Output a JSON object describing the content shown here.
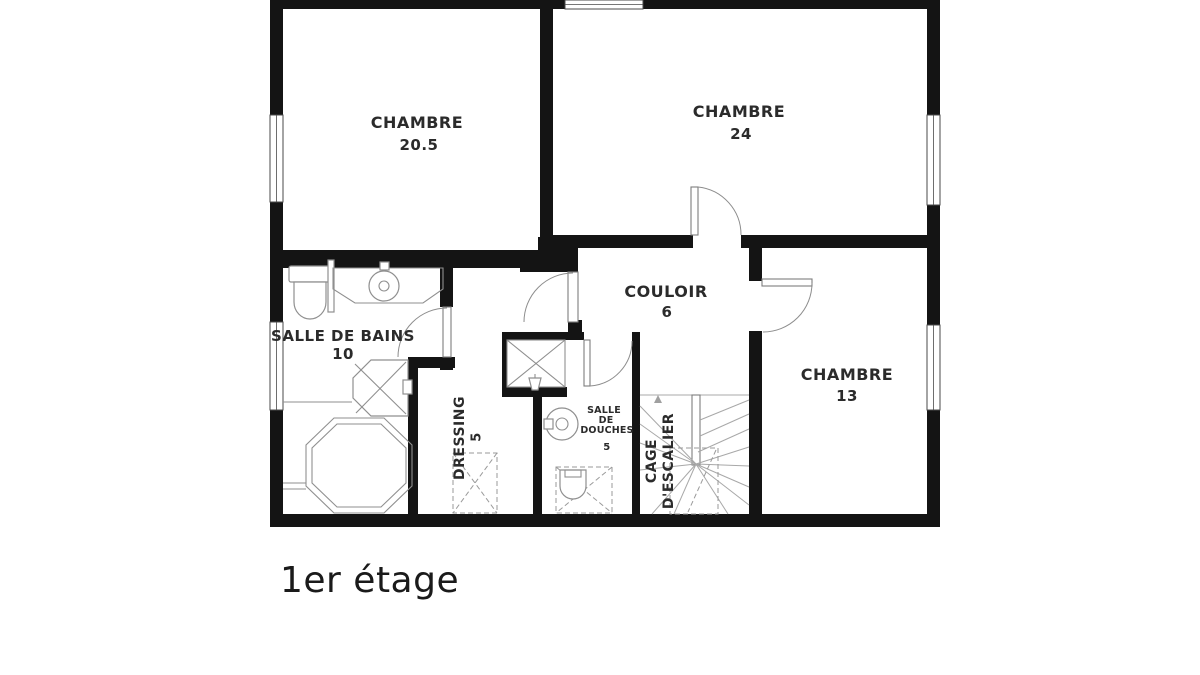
{
  "floor_plan": {
    "floor_label": "1er étage",
    "rooms": {
      "chambre_1": {
        "name": "CHAMBRE",
        "area": "20.5"
      },
      "chambre_2": {
        "name": "CHAMBRE",
        "area": "24"
      },
      "chambre_3": {
        "name": "CHAMBRE",
        "area": "13"
      },
      "salle_de_bains": {
        "name": "SALLE DE BAINS",
        "area": "10"
      },
      "couloir": {
        "name": "COULOIR",
        "area": "6"
      },
      "dressing": {
        "name": "DRESSING",
        "area": "5"
      },
      "salle_de_douches": {
        "line1": "SALLE",
        "line2": "DE",
        "line3": "DOUCHES",
        "area": "5"
      },
      "cage_escalier": {
        "line1": "CAGE",
        "line2": "D'ESCALIER"
      }
    },
    "colors": {
      "wall": "#141414",
      "fixture_stroke": "#8f8f8f",
      "label": "#2b2b2b",
      "background": "#ffffff"
    }
  }
}
